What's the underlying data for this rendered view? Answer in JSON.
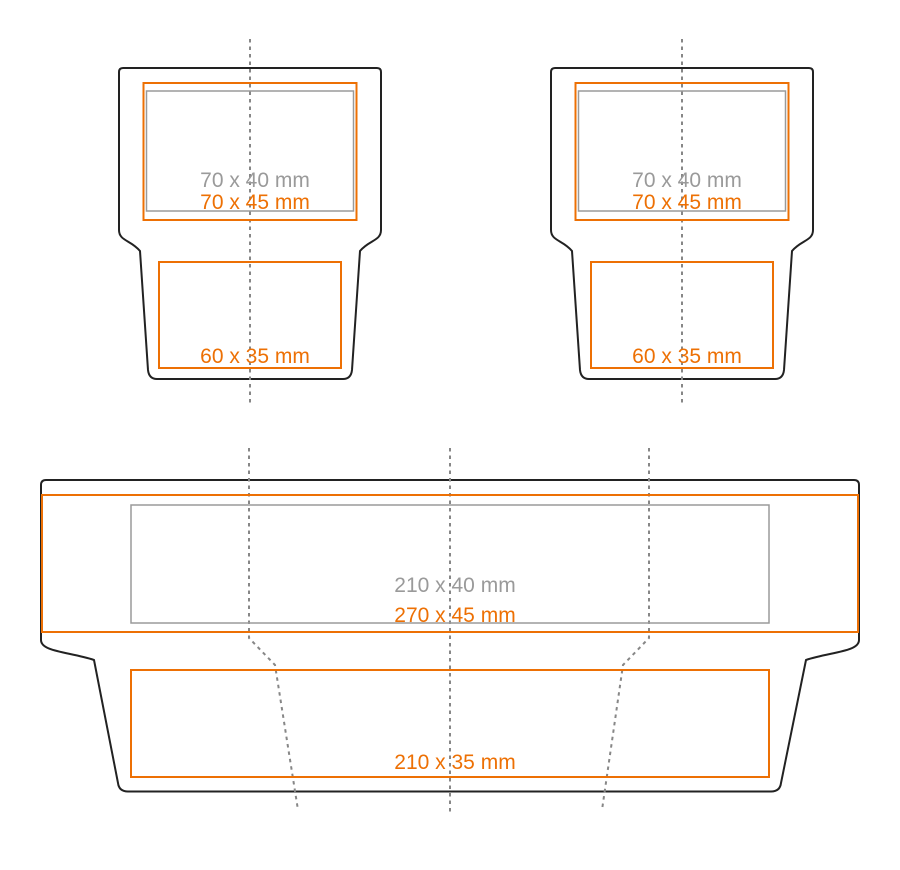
{
  "colors": {
    "background": "#ffffff",
    "outline": "#222222",
    "accent-orange": "#ed7004",
    "muted-gray": "#9a9a9a",
    "fold-gray": "#878787"
  },
  "panels": [
    {
      "name": "small-dieline-left",
      "print_areas": {
        "gray_label": "70 x 40 mm",
        "orange_label": "70 x 45 mm",
        "lower_label": "60 x 35 mm"
      }
    },
    {
      "name": "small-dieline-right",
      "print_areas": {
        "gray_label": "70 x 40 mm",
        "orange_label": "70 x 45 mm",
        "lower_label": "60 x 35 mm"
      }
    },
    {
      "name": "large-dieline",
      "print_areas": {
        "gray_label": "210 x 40 mm",
        "orange_label": "270 x 45 mm",
        "lower_label": "210 x 35 mm"
      }
    }
  ]
}
